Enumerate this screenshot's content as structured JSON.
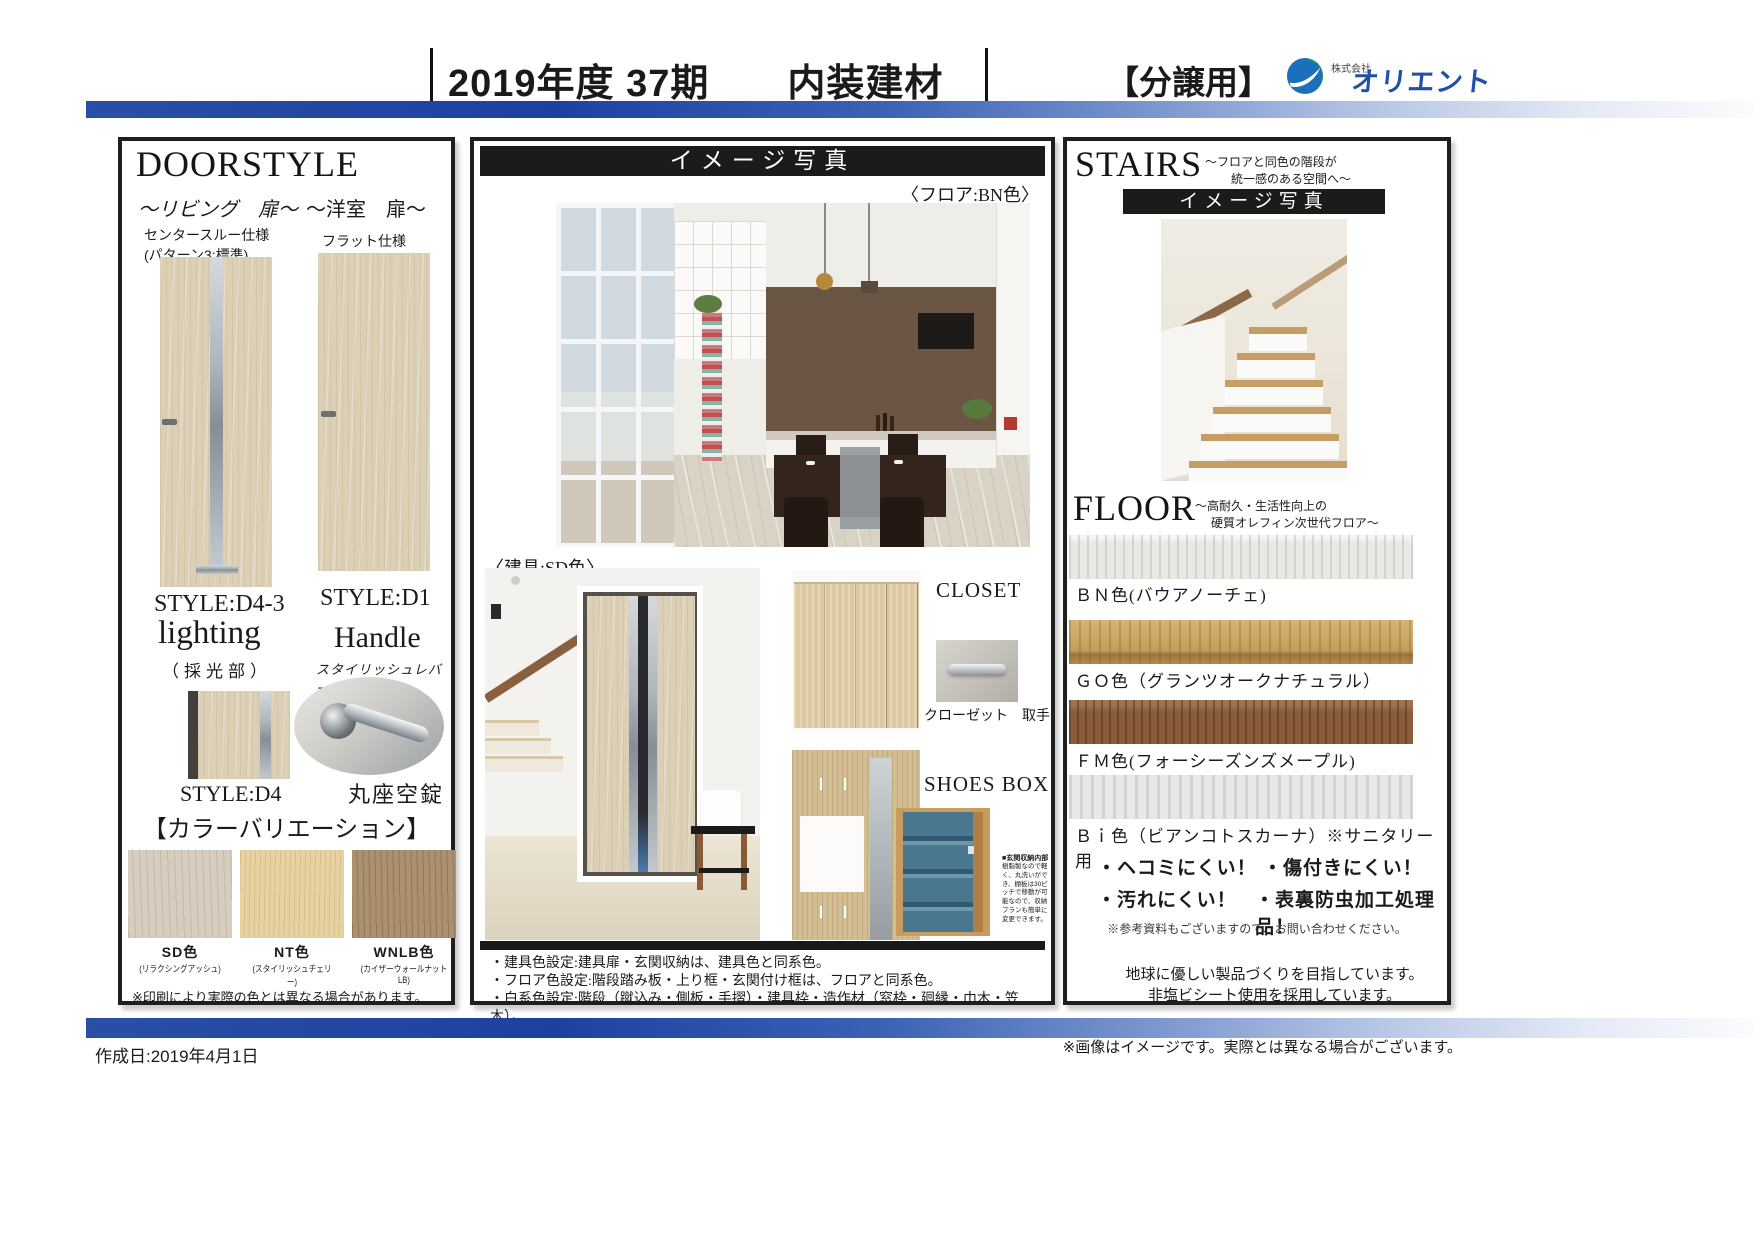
{
  "header": {
    "title": "2019年度 37期　　内装建材",
    "tag": "【分譲用】",
    "company_prefix": "株式会社",
    "company_name": "オリエント",
    "accent_blue": "#1e41a0"
  },
  "doorstyle": {
    "title": "DOORSTYLE",
    "living": {
      "label": "～リビング　扉～",
      "spec1": "センタースルー仕様",
      "spec2": "(パターン3:標準)",
      "style": "STYLE:D4-3"
    },
    "western": {
      "label": "～洋室　扉～",
      "spec1": "フラット仕様",
      "style": "STYLE:D1"
    },
    "lighting": {
      "title": "lighting",
      "sub": "（採光部）",
      "style": "STYLE:D4"
    },
    "handle": {
      "title": "Handle",
      "sub": "スタイリッシュレバー",
      "lock": "丸座空錠"
    },
    "color_variation": {
      "title": "【カラーバリエーション】",
      "colors": [
        {
          "name": "SD色",
          "desc": "(リラクシングアッシュ)",
          "hex": "#d6cdbf"
        },
        {
          "name": "NT色",
          "desc": "(スタイリッシュチェリー)",
          "hex": "#e7d2a4"
        },
        {
          "name": "WNLB色",
          "desc": "(カイザーウォールナットLB)",
          "hex": "#ab9170"
        }
      ],
      "note": "※印刷により実際の色とは異なる場合があります。"
    }
  },
  "gallery": {
    "header": "イメージ写真",
    "floor_caption": "〈フロア:BN色〉",
    "fitting_caption": "〈建具:SD色〉",
    "closet_label": "CLOSET",
    "closet_handle_label": "クローゼット　取手",
    "shoesbox_label": "SHOES BOX",
    "shoesbox_note_title": "■玄関収納内部",
    "shoesbox_note_body": "樹脂製なので軽く、丸洗いができ、棚板は30ピッチで移動が可能なので、収納プランも簡単に変更できます。",
    "notes": [
      "・建具色設定:建具扉・玄関収納は、建具色と同系色。",
      "・フロア色設定:階段踏み板・上り框・玄関付け框は、フロアと同系色。",
      "・白系色設定:階段（蹴込み・側板・手摺）・建具枠・造作材（窓枠・廻縁・巾木・笠木）。"
    ]
  },
  "stairs": {
    "title": "STAIRS",
    "subtitle_line1": "～フロアと同色の階段が",
    "subtitle_line2": "統一感のある空間へ～",
    "photo_header": "イメージ写真"
  },
  "floor": {
    "title": "FLOOR",
    "subtitle_line1": "～高耐久・生活性向上の",
    "subtitle_line2": "硬質オレフィン次世代フロア～",
    "colors": [
      {
        "label": "ＢＮ色(バウアノーチェ)",
        "hex": "#eae8e2"
      },
      {
        "label": "ＧＯ色（グランツオークナチュラル）",
        "hex": "#c9a565"
      },
      {
        "label": "ＦＭ色(フォーシーズンズメープル)",
        "hex": "#8a5c39"
      },
      {
        "label": "Ｂｉ色（ビアンコトスカーナ）※サニタリー用",
        "hex": "#e7e9e7"
      }
    ],
    "features": [
      "・ヘコミにくい！",
      "・傷付きにくい！",
      "・汚れにくい！",
      "・表裏防虫加工処理品！"
    ],
    "ref_note": "※参考資料もございますので、お問い合わせください。",
    "eco_line1": "地球に優しい製品づくりを目指しています。",
    "eco_line2": "非塩ビシート使用を採用しています。"
  },
  "footer": {
    "created": "作成日:2019年4月1日",
    "disclaimer": "※画像はイメージです。実際とは異なる場合がございます。"
  }
}
